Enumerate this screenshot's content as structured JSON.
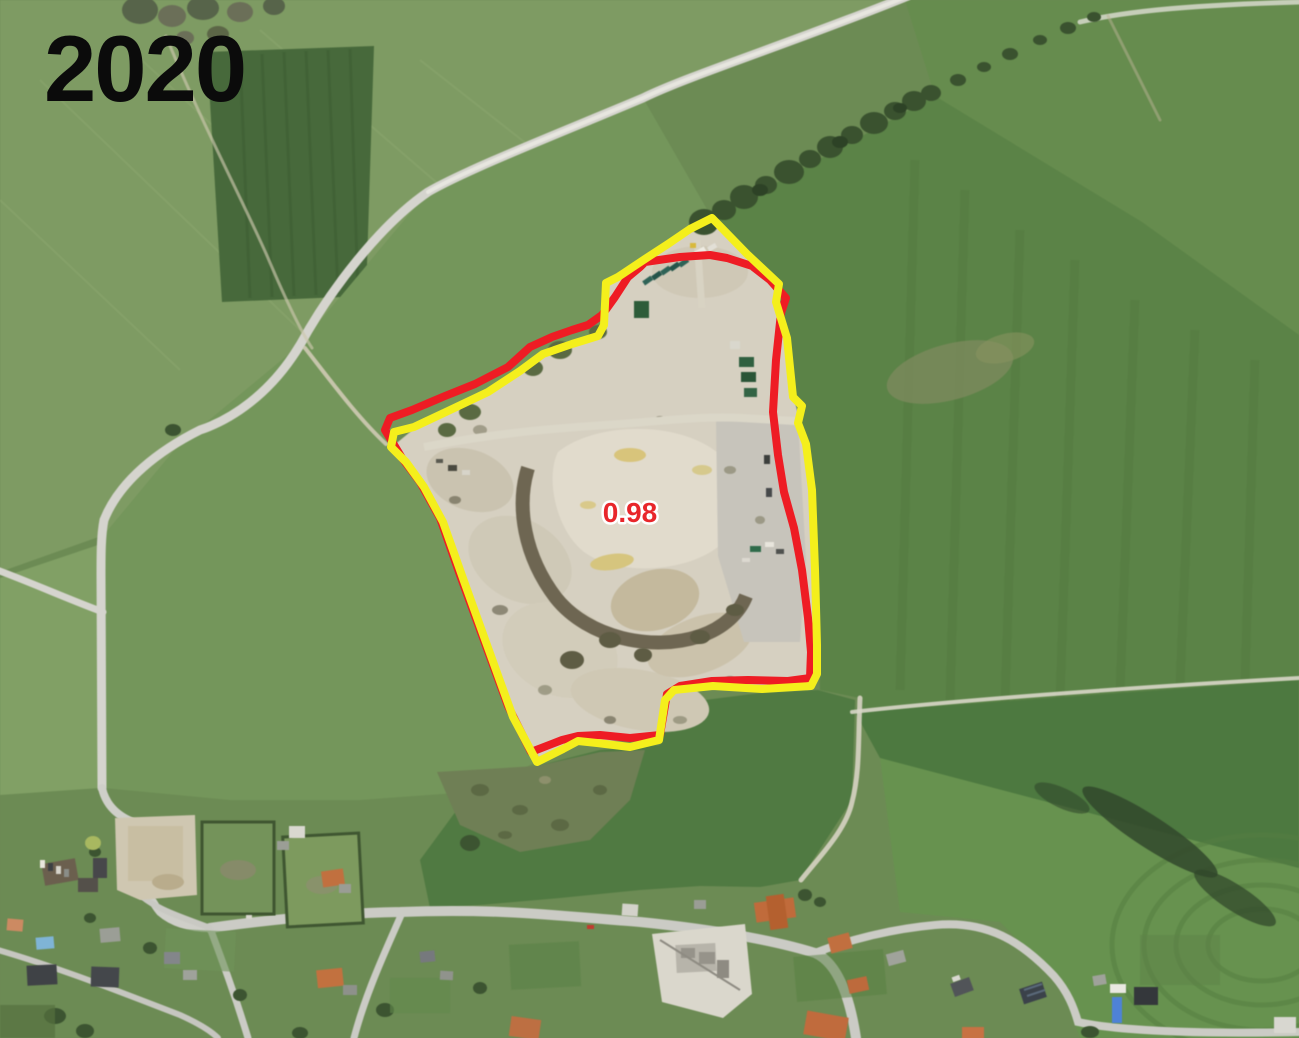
{
  "map": {
    "year_label": "2020",
    "year_label_color": "#0b0b0b",
    "area_label": "0.98",
    "area_label_color": "#e8262b",
    "area_label_halo": "#ffffff",
    "overlays": {
      "red_boundary": {
        "color": "#ee1c24",
        "stroke_width": 8,
        "points": "645,262 680,257 710,255 727,258 752,266 770,280 786,298 781,313 776,360 773,412 778,455 784,492 794,528 802,570 808,618 811,652 810,678 788,681 748,680 712,681 680,686 667,694 660,735 630,738 600,735 578,736 562,740 531,752 508,706 482,635 460,575 440,518 420,482 402,458 385,430 390,418 412,410 445,396 475,384 508,367 530,347 552,337 572,330 588,325 602,315 615,297 628,277 640,267"
      },
      "yellow_boundary": {
        "color": "#f4ef1c",
        "stroke_width": 8,
        "points": "712,218 747,254 779,284 776,302 787,338 793,397 802,406 798,423 806,444 812,490 815,570 817,645 817,674 811,686 762,689 713,686 674,690 665,700 659,740 630,747 597,743 578,741 563,749 537,762 513,717 487,645 465,584 443,522 424,487 406,462 391,447 394,432 414,427 448,411 488,392 520,371 543,354 572,344 598,336 604,325 606,283 618,277 645,259 668,244 690,229"
      }
    }
  }
}
